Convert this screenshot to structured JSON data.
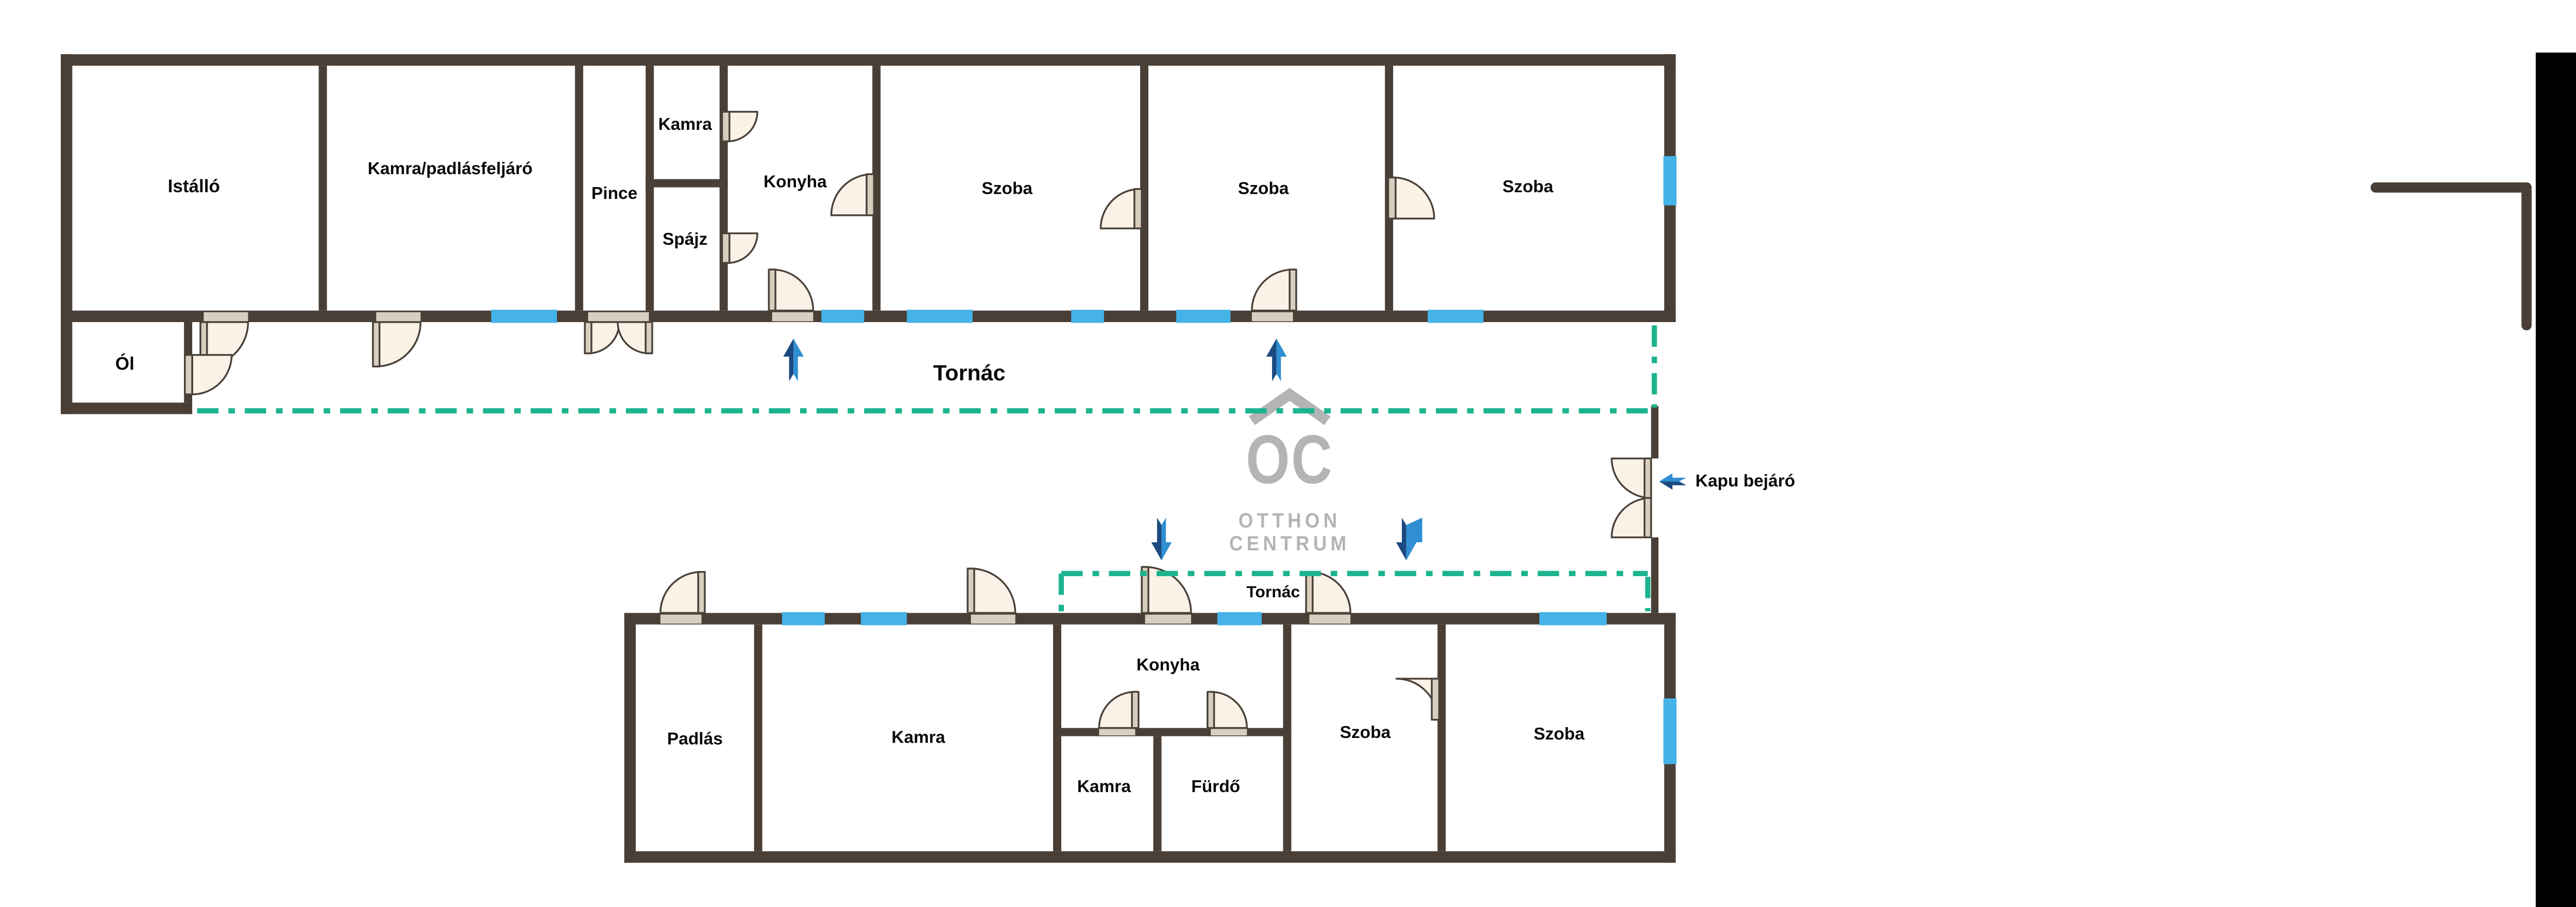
{
  "document": {
    "type": "floor-plan",
    "brand": "Otthon Centrum"
  },
  "colors": {
    "wall": "#4a3f36",
    "window_blue": "#45b2e8",
    "porch_line_green": "#1cb48e",
    "door_fill": "#faf2e7",
    "door_leaf": "#d9cdbd",
    "arrow_dark_blue": "#1b4a80",
    "arrow_light_blue": "#2f8fd2",
    "watermark_gray": "#b2b4b6",
    "label_black": "#0b0b0b"
  },
  "top_building": {
    "rooms": [
      {
        "label": "Istálló"
      },
      {
        "label": "Kamra/padlásfeljáró"
      },
      {
        "label": "Pince"
      },
      {
        "label": "Kamra"
      },
      {
        "label": "Spájz"
      },
      {
        "label": "Konyha"
      },
      {
        "label": "Szoba"
      },
      {
        "label": "Szoba"
      },
      {
        "label": "Szoba"
      },
      {
        "label": "Ól"
      }
    ],
    "porch_label": "Tornác"
  },
  "bottom_building": {
    "rooms": [
      {
        "label": "Padlás"
      },
      {
        "label": "Kamra"
      },
      {
        "label": "Konyha"
      },
      {
        "label": "Kamra"
      },
      {
        "label": "Fürdő"
      },
      {
        "label": "Szoba"
      },
      {
        "label": "Szoba"
      }
    ],
    "porch_label": "Tornác"
  },
  "gate": {
    "entrance_label": "Kapu bejáró"
  },
  "watermark": {
    "logo_text": "OC",
    "line1": "OTTHON",
    "line2": "CENTRUM"
  },
  "icons": [
    "up-arrow-icon",
    "down-arrow-icon",
    "left-arrow-icon",
    "roof-chevron-icon",
    "door-swing",
    "window-marker"
  ]
}
